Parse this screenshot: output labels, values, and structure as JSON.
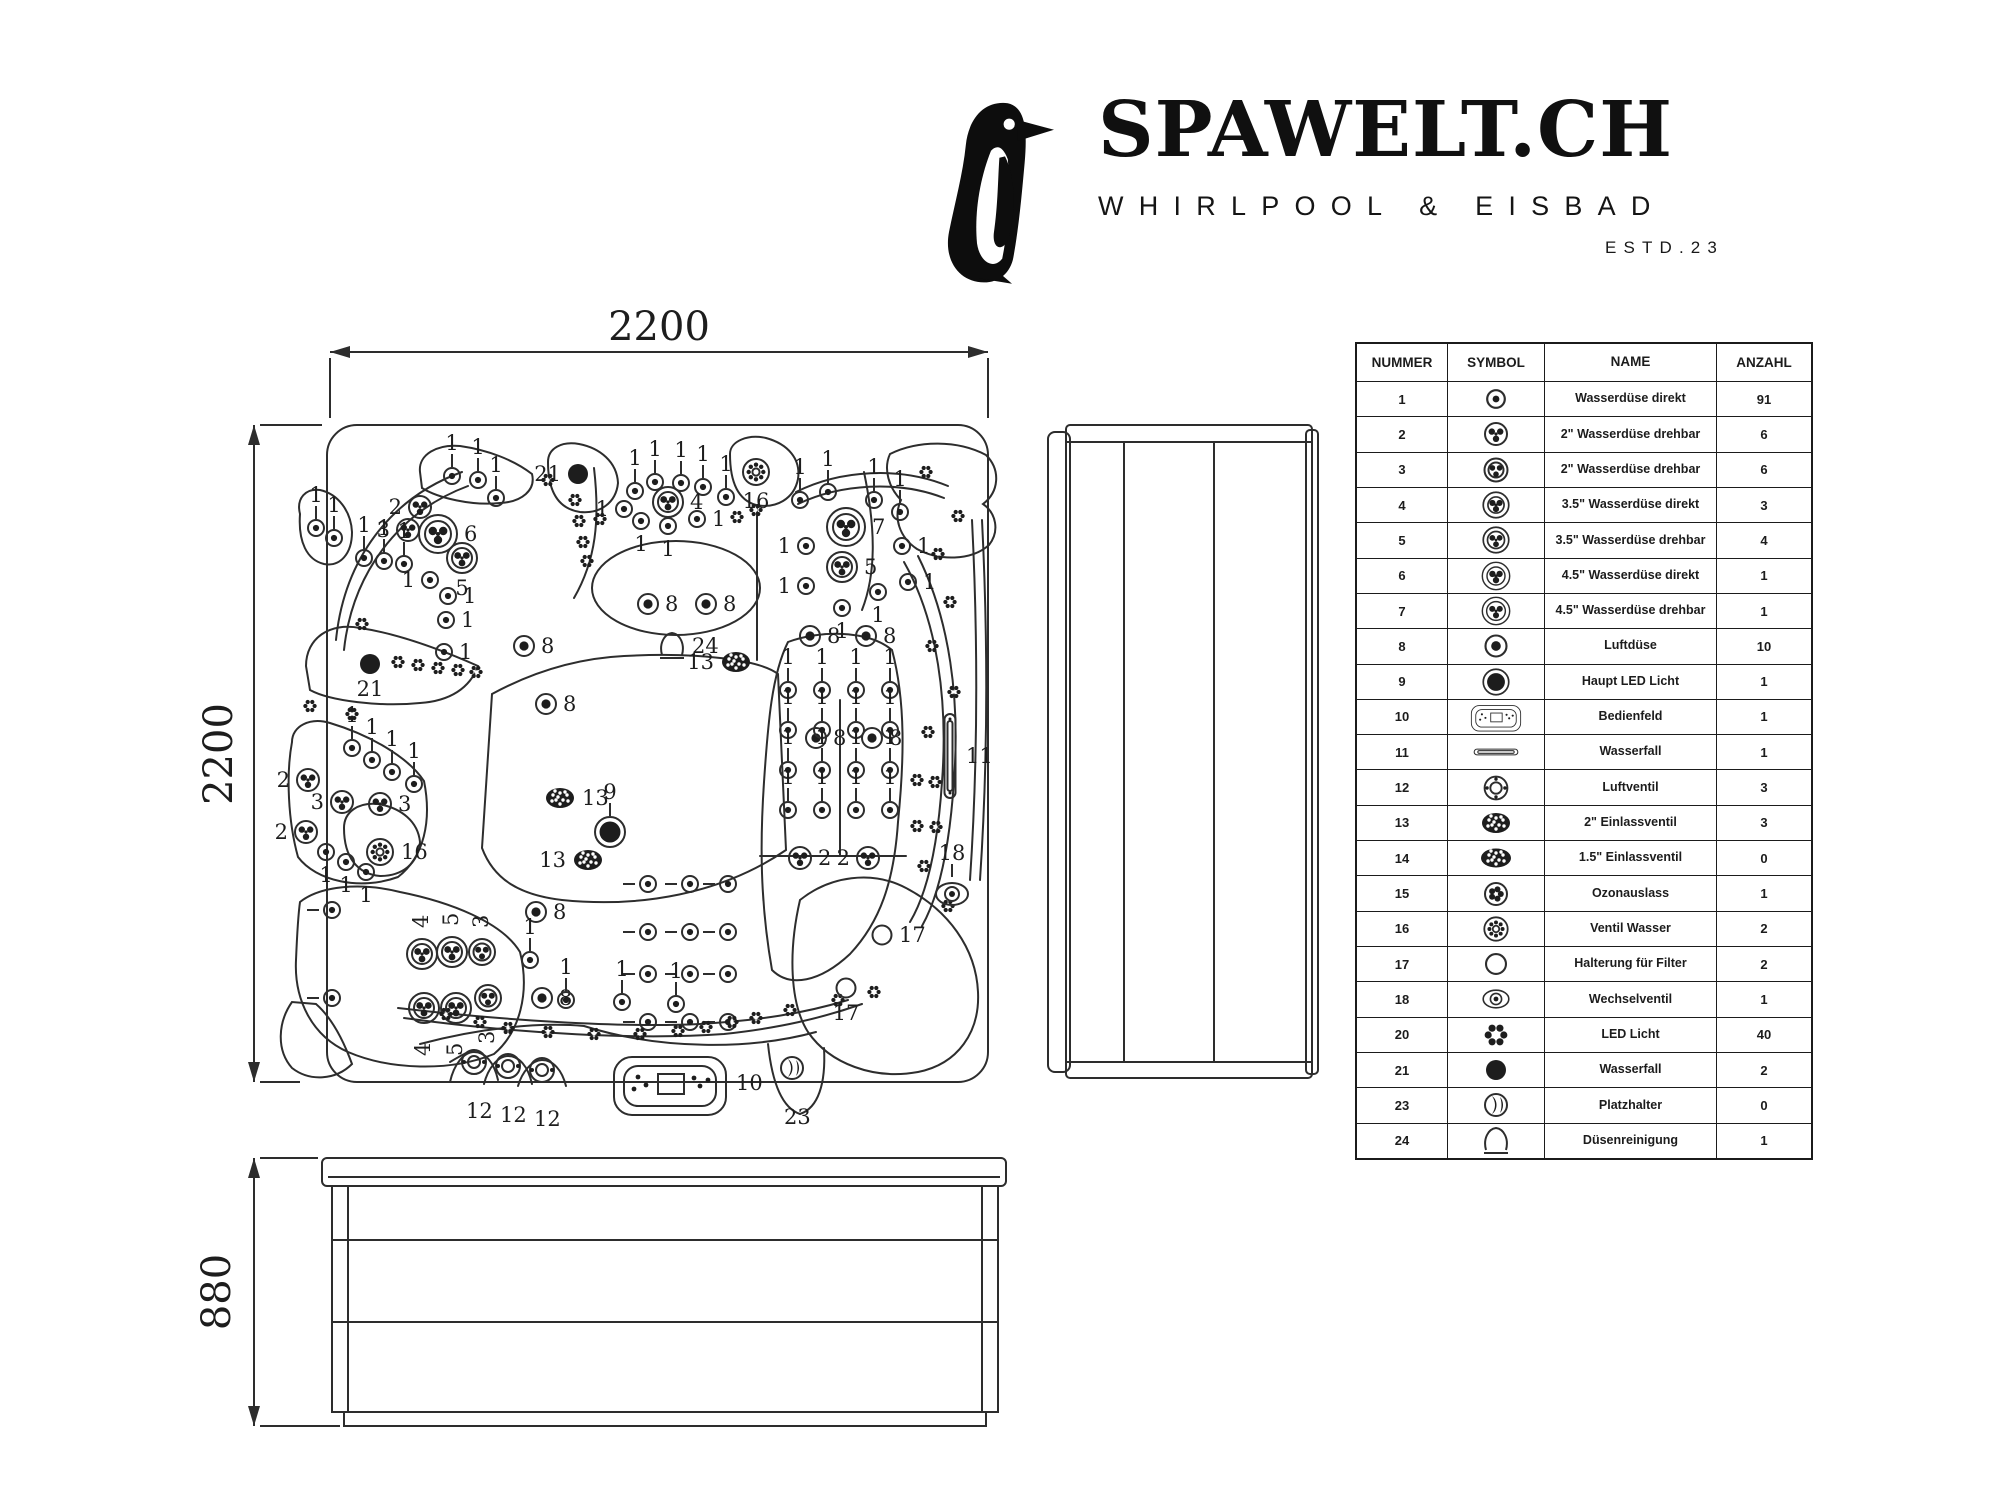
{
  "logo": {
    "brand": "SPAWELT.CH",
    "subtitle": "WHIRLPOOL & EISBAD",
    "established": "ESTD.23"
  },
  "drawing": {
    "top_view": {
      "width_label": "2200",
      "height_label": "2200"
    },
    "front_view": {
      "height_label": "880"
    },
    "jets": [
      [
        452,
        476,
        "d",
        "1",
        "t"
      ],
      [
        478,
        480,
        "d",
        "1",
        "t"
      ],
      [
        496,
        498,
        "d",
        "1",
        "t"
      ],
      [
        316,
        528,
        "d",
        "1",
        "t"
      ],
      [
        334,
        538,
        "d",
        "1",
        "t"
      ],
      [
        364,
        558,
        "d",
        "1",
        "t"
      ],
      [
        384,
        561,
        "d",
        "1",
        "t"
      ],
      [
        404,
        564,
        "d",
        "1",
        "t"
      ],
      [
        420,
        507,
        "r",
        "2",
        "l"
      ],
      [
        408,
        530,
        "r",
        "3",
        "l"
      ],
      [
        438,
        534,
        "R4",
        "6",
        "r"
      ],
      [
        462,
        558,
        "R3",
        "5",
        "b"
      ],
      [
        430,
        580,
        "d",
        "1",
        "l"
      ],
      [
        448,
        596,
        "d",
        "1",
        "r"
      ],
      [
        446,
        620,
        "d",
        "1",
        "r"
      ],
      [
        444,
        652,
        "d",
        "1",
        "r"
      ],
      [
        548,
        480,
        "f"
      ],
      [
        362,
        624,
        "f"
      ],
      [
        310,
        706,
        "f"
      ],
      [
        575,
        500,
        "f"
      ],
      [
        579,
        521,
        "f"
      ],
      [
        583,
        542,
        "f"
      ],
      [
        587,
        561,
        "f"
      ],
      [
        578,
        474,
        "k",
        "21",
        "l"
      ],
      [
        635,
        491,
        "d",
        "1",
        "t"
      ],
      [
        655,
        482,
        "d",
        "1",
        "t"
      ],
      [
        681,
        483,
        "d",
        "1",
        "t"
      ],
      [
        703,
        487,
        "d",
        "1",
        "t"
      ],
      [
        726,
        497,
        "d",
        "1",
        "t"
      ],
      [
        624,
        509,
        "d",
        "1",
        "l"
      ],
      [
        641,
        521,
        "d",
        "1",
        "b"
      ],
      [
        668,
        526,
        "d",
        "1",
        "b"
      ],
      [
        697,
        519,
        "d",
        "1",
        "r"
      ],
      [
        668,
        502,
        "R3",
        "4",
        "r"
      ],
      [
        600,
        519,
        "f"
      ],
      [
        737,
        517,
        "f"
      ],
      [
        756,
        510,
        "f"
      ],
      [
        756,
        472,
        "v",
        "16",
        "b"
      ],
      [
        846,
        527,
        "R4",
        "7",
        "r"
      ],
      [
        842,
        567,
        "R3",
        "5",
        "r"
      ],
      [
        800,
        500,
        "d",
        "1",
        "t"
      ],
      [
        828,
        492,
        "d",
        "1",
        "t"
      ],
      [
        874,
        500,
        "d",
        "1",
        "t"
      ],
      [
        900,
        512,
        "d",
        "1",
        "t"
      ],
      [
        806,
        546,
        "d",
        "1",
        "l"
      ],
      [
        902,
        546,
        "d",
        "1",
        "r"
      ],
      [
        806,
        586,
        "d",
        "1",
        "l"
      ],
      [
        878,
        592,
        "d",
        "1",
        "b"
      ],
      [
        908,
        582,
        "d",
        "1",
        "r"
      ],
      [
        842,
        608,
        "d",
        "1",
        "b"
      ],
      [
        926,
        472,
        "f"
      ],
      [
        958,
        516,
        "f"
      ],
      [
        938,
        554,
        "f"
      ],
      [
        950,
        602,
        "f"
      ],
      [
        932,
        646,
        "f"
      ],
      [
        954,
        692,
        "f"
      ],
      [
        928,
        732,
        "f"
      ],
      [
        917,
        780,
        "f"
      ],
      [
        935,
        782,
        "f"
      ],
      [
        917,
        826,
        "f"
      ],
      [
        936,
        827,
        "f"
      ],
      [
        924,
        866,
        "f"
      ],
      [
        948,
        906,
        "f"
      ],
      [
        648,
        604,
        "a",
        "8",
        "r"
      ],
      [
        706,
        604,
        "a",
        "8",
        "r"
      ],
      [
        810,
        636,
        "a",
        "8",
        "r"
      ],
      [
        866,
        636,
        "a",
        "8",
        "r"
      ],
      [
        816,
        738,
        "a",
        "8",
        "r"
      ],
      [
        872,
        738,
        "a",
        "8",
        "r"
      ],
      [
        524,
        646,
        "a",
        "8",
        "r"
      ],
      [
        546,
        704,
        "a",
        "8",
        "r"
      ],
      [
        536,
        912,
        "a",
        "8",
        "r"
      ],
      [
        542,
        998,
        "a",
        "8",
        "r"
      ],
      [
        672,
        646,
        "c",
        "24",
        "r"
      ],
      [
        736,
        662,
        "i",
        "13",
        "l"
      ],
      [
        560,
        798,
        "i",
        "13",
        "r"
      ],
      [
        588,
        860,
        "i",
        "13",
        "l"
      ],
      [
        610,
        832,
        "K",
        "9",
        "t"
      ],
      [
        370,
        664,
        "k",
        "21",
        "b"
      ],
      [
        398,
        662,
        "f"
      ],
      [
        418,
        665,
        "f"
      ],
      [
        438,
        668,
        "f"
      ],
      [
        458,
        670,
        "f"
      ],
      [
        476,
        672,
        "f"
      ],
      [
        352,
        748,
        "d",
        "1",
        "t"
      ],
      [
        372,
        760,
        "d",
        "1",
        "t"
      ],
      [
        392,
        772,
        "d",
        "1",
        "t"
      ],
      [
        414,
        784,
        "d",
        "1",
        "t"
      ],
      [
        308,
        780,
        "r",
        "2",
        "l"
      ],
      [
        342,
        802,
        "r",
        "3",
        "l"
      ],
      [
        380,
        804,
        "r",
        "3",
        "r"
      ],
      [
        306,
        832,
        "r",
        "2",
        "l"
      ],
      [
        326,
        852,
        "d",
        "1",
        "b"
      ],
      [
        346,
        862,
        "d",
        "1",
        "b"
      ],
      [
        366,
        872,
        "d",
        "1",
        "b"
      ],
      [
        352,
        714,
        "f"
      ],
      [
        380,
        852,
        "v",
        "16",
        "r"
      ],
      [
        788,
        690,
        "d",
        "1",
        "t"
      ],
      [
        822,
        690,
        "d",
        "1",
        "t"
      ],
      [
        856,
        690,
        "d",
        "1",
        "t"
      ],
      [
        890,
        690,
        "d",
        "1",
        "t"
      ],
      [
        788,
        730,
        "d",
        "1",
        "t"
      ],
      [
        822,
        730,
        "d",
        "1",
        "t"
      ],
      [
        856,
        730,
        "d",
        "1",
        "t"
      ],
      [
        890,
        730,
        "d",
        "1",
        "t"
      ],
      [
        788,
        770,
        "d",
        "1",
        "t"
      ],
      [
        822,
        770,
        "d",
        "1",
        "t"
      ],
      [
        856,
        770,
        "d",
        "1",
        "t"
      ],
      [
        890,
        770,
        "d",
        "1",
        "t"
      ],
      [
        788,
        810,
        "d",
        "1",
        "t"
      ],
      [
        822,
        810,
        "d",
        "1",
        "t"
      ],
      [
        856,
        810,
        "d",
        "1",
        "t"
      ],
      [
        890,
        810,
        "d",
        "1",
        "t"
      ],
      [
        800,
        858,
        "r",
        "2",
        "r"
      ],
      [
        868,
        858,
        "r",
        "2",
        "l"
      ],
      [
        648,
        884,
        "d",
        null,
        "dash"
      ],
      [
        690,
        884,
        "d",
        null,
        "dash"
      ],
      [
        728,
        884,
        "d",
        null,
        "dash"
      ],
      [
        648,
        932,
        "d",
        null,
        "dash"
      ],
      [
        690,
        932,
        "d",
        null,
        "dash"
      ],
      [
        728,
        932,
        "d",
        null,
        "dash"
      ],
      [
        648,
        974,
        "d",
        null,
        "dash"
      ],
      [
        690,
        974,
        "d",
        null,
        "dash"
      ],
      [
        728,
        974,
        "d",
        null,
        "dash"
      ],
      [
        648,
        1022,
        "d",
        null,
        "dash"
      ],
      [
        690,
        1022,
        "d",
        null,
        "dash"
      ],
      [
        728,
        1022,
        "d",
        null,
        "dash"
      ],
      [
        566,
        1000,
        "d",
        "1",
        "t"
      ],
      [
        622,
        1002,
        "d",
        "1",
        "t"
      ],
      [
        676,
        1004,
        "d",
        "1",
        "t"
      ],
      [
        530,
        960,
        "d",
        "1",
        "t"
      ],
      [
        422,
        954,
        "R3",
        "4",
        "rt"
      ],
      [
        452,
        952,
        "R3",
        "5",
        "rt"
      ],
      [
        482,
        952,
        "R2",
        "3",
        "rt"
      ],
      [
        424,
        1008,
        "R3",
        "4",
        "rb"
      ],
      [
        456,
        1008,
        "R3",
        "5",
        "rb"
      ],
      [
        488,
        998,
        "R2",
        "3",
        "rb"
      ],
      [
        332,
        910,
        "d",
        null,
        "dash"
      ],
      [
        332,
        998,
        "d",
        null,
        "dash"
      ],
      [
        446,
        1014,
        "f"
      ],
      [
        480,
        1022,
        "f"
      ],
      [
        508,
        1028,
        "f"
      ],
      [
        548,
        1032,
        "f"
      ],
      [
        594,
        1034,
        "f"
      ],
      [
        640,
        1034,
        "f"
      ],
      [
        678,
        1031,
        "f"
      ],
      [
        706,
        1027,
        "f"
      ],
      [
        732,
        1022,
        "f"
      ],
      [
        756,
        1018,
        "f"
      ],
      [
        790,
        1010,
        "f"
      ],
      [
        838,
        1000,
        "f"
      ],
      [
        874,
        992,
        "f"
      ],
      [
        950,
        756,
        "slot",
        "11",
        "r"
      ],
      [
        952,
        894,
        "w",
        "18",
        "t"
      ],
      [
        882,
        935,
        "o",
        "17",
        "r"
      ],
      [
        846,
        988,
        "o",
        "17",
        "b"
      ],
      [
        670,
        1083,
        "panel",
        "10",
        "r"
      ],
      [
        792,
        1068,
        "ph",
        "23",
        "B"
      ],
      [
        474,
        1062,
        "q",
        "12",
        "B"
      ],
      [
        508,
        1066,
        "q",
        "12",
        "B"
      ],
      [
        542,
        1070,
        "q",
        "12",
        "B"
      ]
    ]
  },
  "table": {
    "headers": [
      "NUMMER",
      "SYMBOL",
      "NAME",
      "ANZAHL"
    ],
    "rows": [
      [
        "1",
        "jd",
        "Wasserdüse direkt",
        "91"
      ],
      [
        "2",
        "jr",
        "2\" Wasserdüse drehbar",
        "6"
      ],
      [
        "3",
        "jr2",
        "2\" Wasserdüse drehbar",
        "6"
      ],
      [
        "4",
        "j35d",
        "3.5\" Wasserdüse direkt",
        "3"
      ],
      [
        "5",
        "j35r",
        "3.5\" Wasserdüse drehbar",
        "4"
      ],
      [
        "6",
        "j45d",
        "4.5\" Wasserdüse direkt",
        "1"
      ],
      [
        "7",
        "j45r",
        "4.5\" Wasserdüse drehbar",
        "1"
      ],
      [
        "8",
        "air",
        "Luftdüse",
        "10"
      ],
      [
        "9",
        "mled",
        "Haupt LED Licht",
        "1"
      ],
      [
        "10",
        "panel",
        "Bedienfeld",
        "1"
      ],
      [
        "11",
        "sloth",
        "Wasserfall",
        "1"
      ],
      [
        "12",
        "lv",
        "Luftventil",
        "3"
      ],
      [
        "13",
        "in2",
        "2\" Einlassventil",
        "3"
      ],
      [
        "14",
        "in15",
        "1.5\" Einlassventil",
        "0"
      ],
      [
        "15",
        "oz",
        "Ozonauslass",
        "1"
      ],
      [
        "16",
        "vw",
        "Ventil Wasser",
        "2"
      ],
      [
        "17",
        "fr",
        "Halterung für Filter",
        "2"
      ],
      [
        "18",
        "wv",
        "Wechselventil",
        "1"
      ],
      [
        "20",
        "led",
        "LED Licht",
        "40"
      ],
      [
        "21",
        "wfd",
        "Wasserfall",
        "2"
      ],
      [
        "23",
        "ph",
        "Platzhalter",
        "0"
      ],
      [
        "24",
        "cone",
        "Düsenreinigung",
        "1"
      ]
    ]
  }
}
